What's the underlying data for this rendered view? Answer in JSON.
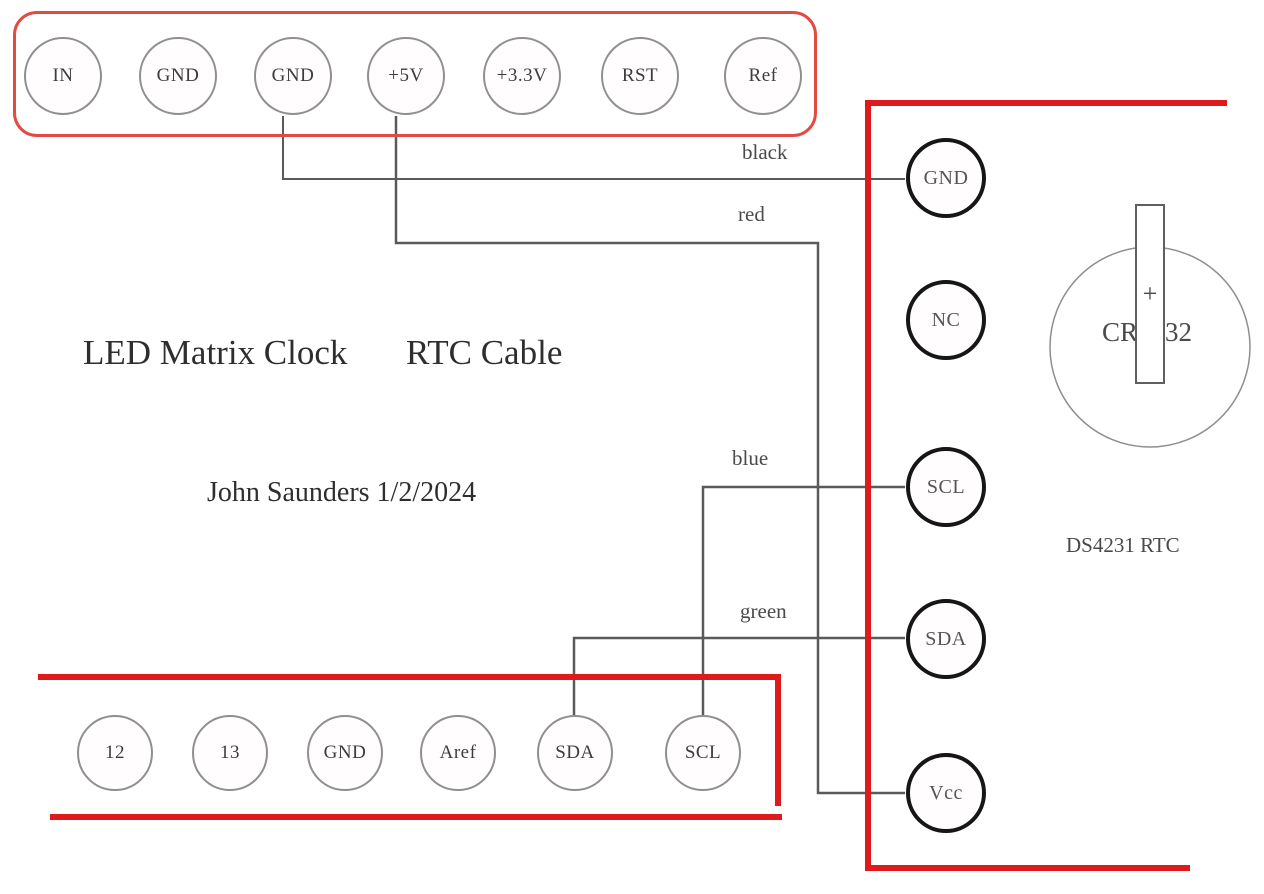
{
  "diagram": {
    "title_left": "LED Matrix Clock",
    "title_right": "RTC Cable",
    "author": "John Saunders 1/2/2024",
    "rtc_label": "DS4231 RTC"
  },
  "led_matrix_header": {
    "pins": [
      "IN",
      "GND",
      "GND",
      "+5V",
      "+3.3V",
      "RST",
      "Ref"
    ]
  },
  "arduino_header": {
    "pins": [
      "12",
      "13",
      "GND",
      "Aref",
      "SDA",
      "SCL"
    ]
  },
  "rtc_module": {
    "pins": [
      "GND",
      "NC",
      "SCL",
      "SDA",
      "Vcc"
    ]
  },
  "wire_labels": {
    "black": "black",
    "red": "red",
    "blue": "blue",
    "green": "green"
  },
  "battery": {
    "model": "CR2032",
    "polarity": "+"
  },
  "connections": [
    {
      "from": "GND",
      "to": "GND",
      "wire": "black"
    },
    {
      "from": "+5V",
      "to": "Vcc",
      "wire": "red"
    },
    {
      "from": "SCL",
      "to": "SCL",
      "wire": "blue"
    },
    {
      "from": "SDA",
      "to": "SDA",
      "wire": "green"
    }
  ],
  "colors": {
    "frame_red": "#e01a1a",
    "header_outline_red": "#e24a44",
    "wire_gray": "#5a5a5a",
    "pin_outline_gray": "#8f8f8f",
    "rtc_pin_black": "#161616",
    "text": "#3c3c3c"
  }
}
